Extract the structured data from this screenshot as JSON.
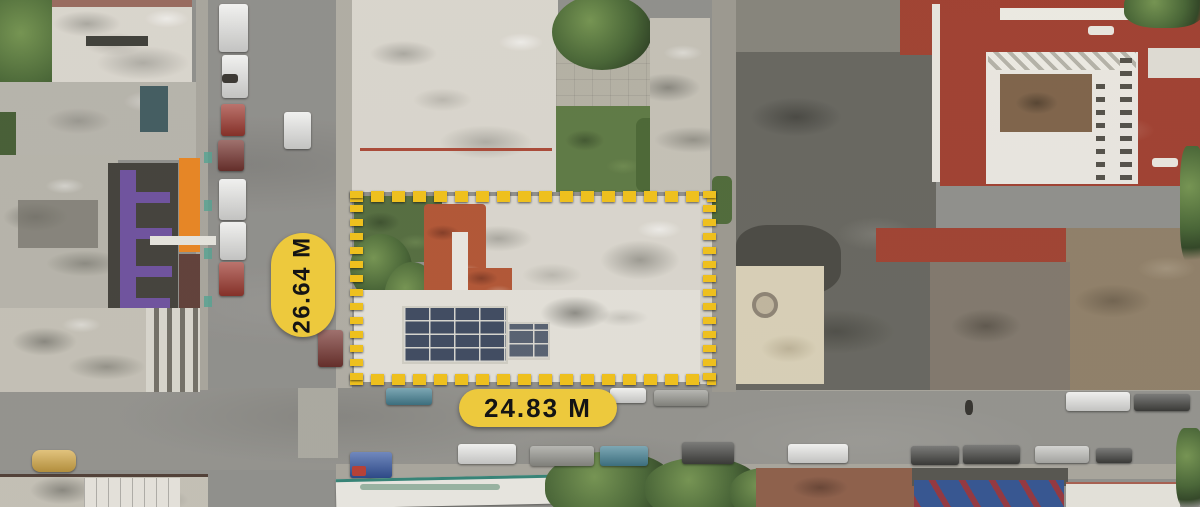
{
  "image": {
    "type": "aerial-drone-photo",
    "subject": "urban property lot outlined for sale"
  },
  "annotations": {
    "side_measurement": "26.64 M",
    "front_measurement": "24.83 M",
    "boundary_style": "dashed-rectangle"
  },
  "scene": {
    "features": [
      "flat-white-rooftops",
      "terracotta-roof-patches",
      "solar-panel-array",
      "garden-trees",
      "street-intersection",
      "parked-cars",
      "red-roofed-building",
      "delivery-trailer"
    ]
  },
  "colors": {
    "label-bg": "#EDC93D",
    "label-text": "#141414",
    "boundary-yellow": "#EEC01E",
    "asphalt": "#8D8C88",
    "roof-white": "#D9D5CC",
    "roof-red": "#9E3B2B",
    "roof-terracotta": "#B0512F",
    "roof-dark": "#63625B",
    "vegetation": "#42602F",
    "solar-panel": "#39455B",
    "storefront-orange": "#E8821C",
    "storefront-purple": "#6A4D9C"
  }
}
